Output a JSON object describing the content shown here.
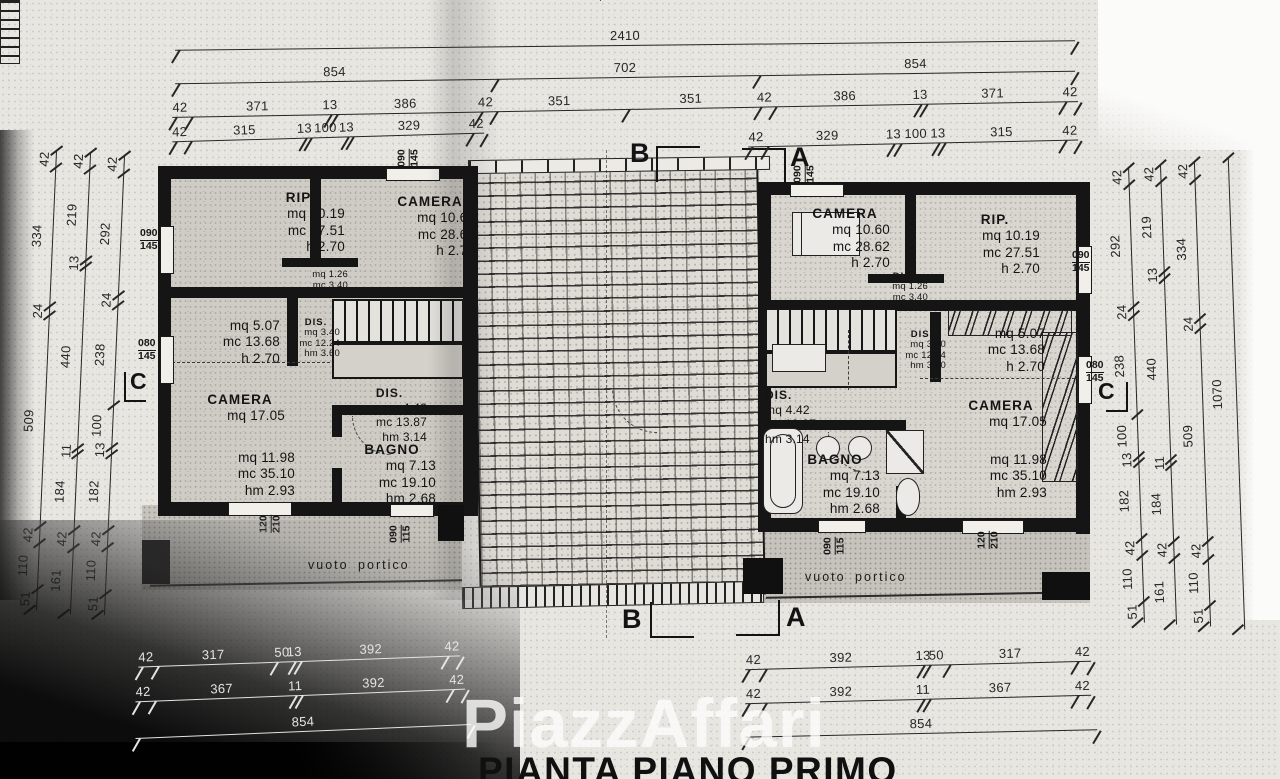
{
  "title": "PIANTA PIANO PRIMO",
  "watermark": "PiazzAffari",
  "markers": {
    "a": "A",
    "b": "B",
    "c": "C"
  },
  "dims": {
    "top_total": [
      "2410"
    ],
    "top_row2": [
      "854",
      "702",
      "854"
    ],
    "top_row3": [
      "42",
      "371",
      "13",
      "386",
      "42",
      "351",
      "351",
      "42",
      "386",
      "13",
      "371",
      "42"
    ],
    "top_row4_left": [
      "42",
      "315",
      "13",
      "100",
      "13",
      "329",
      "42"
    ],
    "top_row4_right": [
      "42",
      "329",
      "13",
      "100",
      "13",
      "315",
      "42"
    ],
    "bottom_left_row1": [
      "42",
      "317",
      "50",
      "13",
      "392",
      "42"
    ],
    "bottom_left_row2": [
      "42",
      "367",
      "11",
      "392",
      "42"
    ],
    "bottom_left_row3": [
      "854"
    ],
    "bottom_right_row1": [
      "42",
      "392",
      "13",
      "50",
      "317",
      "42"
    ],
    "bottom_right_row2": [
      "42",
      "392",
      "11",
      "367",
      "42"
    ],
    "bottom_right_row3": [
      "854"
    ],
    "left_v_outer": [
      "42",
      "334",
      "24",
      "509",
      "42",
      "110",
      "51"
    ],
    "left_v_mid": [
      "42",
      "219",
      "13",
      "440",
      "11",
      "184",
      "42",
      "161"
    ],
    "left_v_inner": [
      "42",
      "292",
      "24",
      "238",
      "100",
      "13",
      "182",
      "42",
      "110",
      "51"
    ],
    "right_v_inner": [
      "42",
      "292",
      "24",
      "238",
      "100",
      "13",
      "182",
      "42",
      "110",
      "51"
    ],
    "right_v_mid": [
      "42",
      "219",
      "13",
      "440",
      "11",
      "184",
      "42",
      "161"
    ],
    "right_v_outer": [
      "42",
      "334",
      "24",
      "509",
      "42",
      "110",
      "51"
    ],
    "right_v_total": [
      "1070"
    ]
  },
  "rooms": {
    "l_rip": {
      "name": "RIP.",
      "l1": "mq  10.19",
      "l2": "mc  27.51",
      "l3": "h  2.70"
    },
    "l_cam1": {
      "name": "CAMERA",
      "l1": "mq  10.60",
      "l2": "mc  28.62",
      "l3": "h  2.70"
    },
    "l_dis1": {
      "name": "DIS.",
      "l1": "mq  1.26",
      "l2": "mc  3.40",
      "l3": "h  2.70"
    },
    "l_r507": {
      "l1": "mq  5.07",
      "l2": "mc  13.68",
      "l3": "h  2.70"
    },
    "l_dis2": {
      "name": "DIS.",
      "l1": "mq  3.40",
      "l2": "mc  12.24",
      "l3": "hm  3.60"
    },
    "l_cam2": {
      "name": "CAMERA",
      "l1": "mq  17.05"
    },
    "l_dis3": {
      "name": "DIS.",
      "l1": "mq  4.42",
      "l2": "mc  13.87",
      "l3": "hm  3.14"
    },
    "l_r1198": {
      "l1": "mq  11.98",
      "l2": "mc  35.10",
      "l3": "hm  2.93"
    },
    "l_bagno": {
      "name": "BAGNO",
      "l1": "mq  7.13",
      "l2": "mc  19.10",
      "l3": "hm  2.68"
    },
    "r_cam1": {
      "name": "CAMERA",
      "l1": "mq  10.60",
      "l2": "mc  28.62",
      "l3": "h  2.70"
    },
    "r_rip": {
      "name": "RIP.",
      "l1": "mq  10.19",
      "l2": "mc  27.51",
      "l3": "h  2.70"
    },
    "r_dis1": {
      "name": "DIS.",
      "l1": "mq  1.26",
      "l2": "mc  3.40",
      "l3": "h  2.70"
    },
    "r_dis2": {
      "name": "DIS.",
      "l1": "mq  3.40",
      "l2": "mc  12.24",
      "l3": "hm  3.60"
    },
    "r_r507": {
      "l1": "mq  5.07",
      "l2": "mc  13.68",
      "l3": "h  2.70"
    },
    "r_dis3": {
      "name": "DIS.",
      "l1": "mq  4.42",
      "l2": "mc  13.87",
      "l3": "hm  3.14"
    },
    "r_cam2": {
      "name": "CAMERA",
      "l1": "mq  17.05"
    },
    "r_bagno": {
      "name": "BAGNO",
      "l1": "mq  7.13",
      "l2": "mc  19.10",
      "l3": "hm  2.68"
    },
    "r_r1198": {
      "l1": "mq  11.98",
      "l2": "mc  35.10",
      "l3": "hm  2.93"
    },
    "portico": {
      "name": "vuoto portico"
    }
  },
  "win": {
    "w090145": {
      "t": "090",
      "b": "145"
    },
    "w080145": {
      "t": "080",
      "b": "145"
    },
    "w120210": {
      "t": "120",
      "b": "210"
    },
    "w090115": {
      "t": "090",
      "b": "115"
    }
  }
}
